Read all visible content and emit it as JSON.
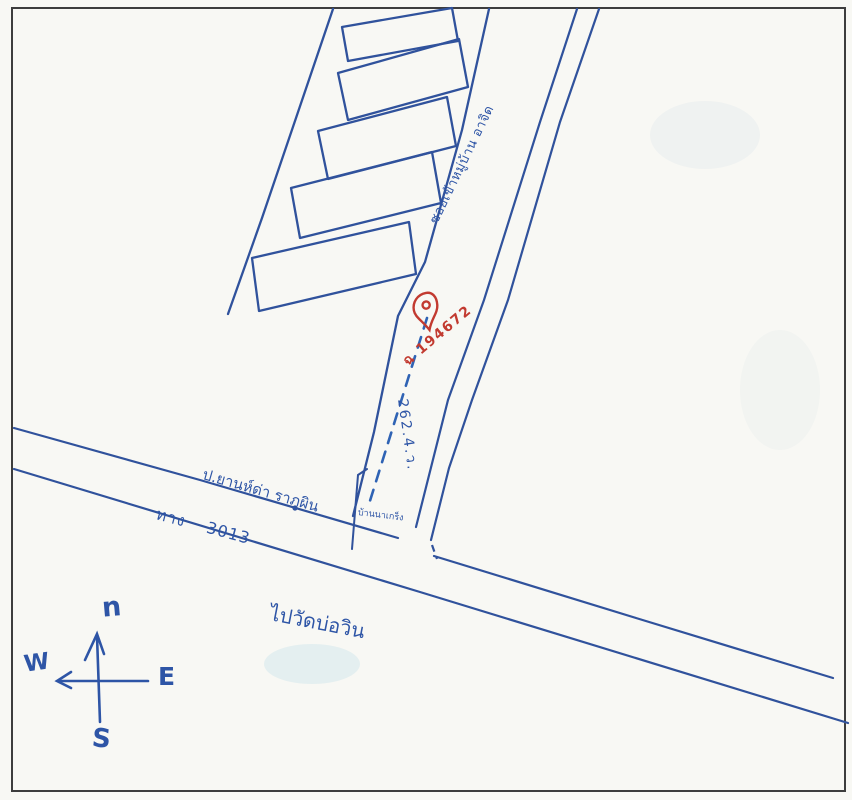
{
  "map": {
    "labels": {
      "soi_name": "ซอยเข้าหมู่บ้าน อาจิด",
      "deed_number": "ฉ 194672",
      "distance_note": "262.4.ว.",
      "landmark": "ป.ยานห์ด่า ราภูผิน",
      "road_number": "ทาง 3013",
      "junction_plot": "บ้านนาเกร็ง",
      "destination": "ไปวัดบ่อวิน"
    },
    "compass": {
      "north": "n",
      "west": "W",
      "east": "E",
      "south": "S"
    },
    "plots": {
      "count": 5
    },
    "colors": {
      "ink_blue": "#2e55a6",
      "marker_red": "#c23a30",
      "frame": "#3d3d3d",
      "paper": "#f8f8f4"
    }
  }
}
